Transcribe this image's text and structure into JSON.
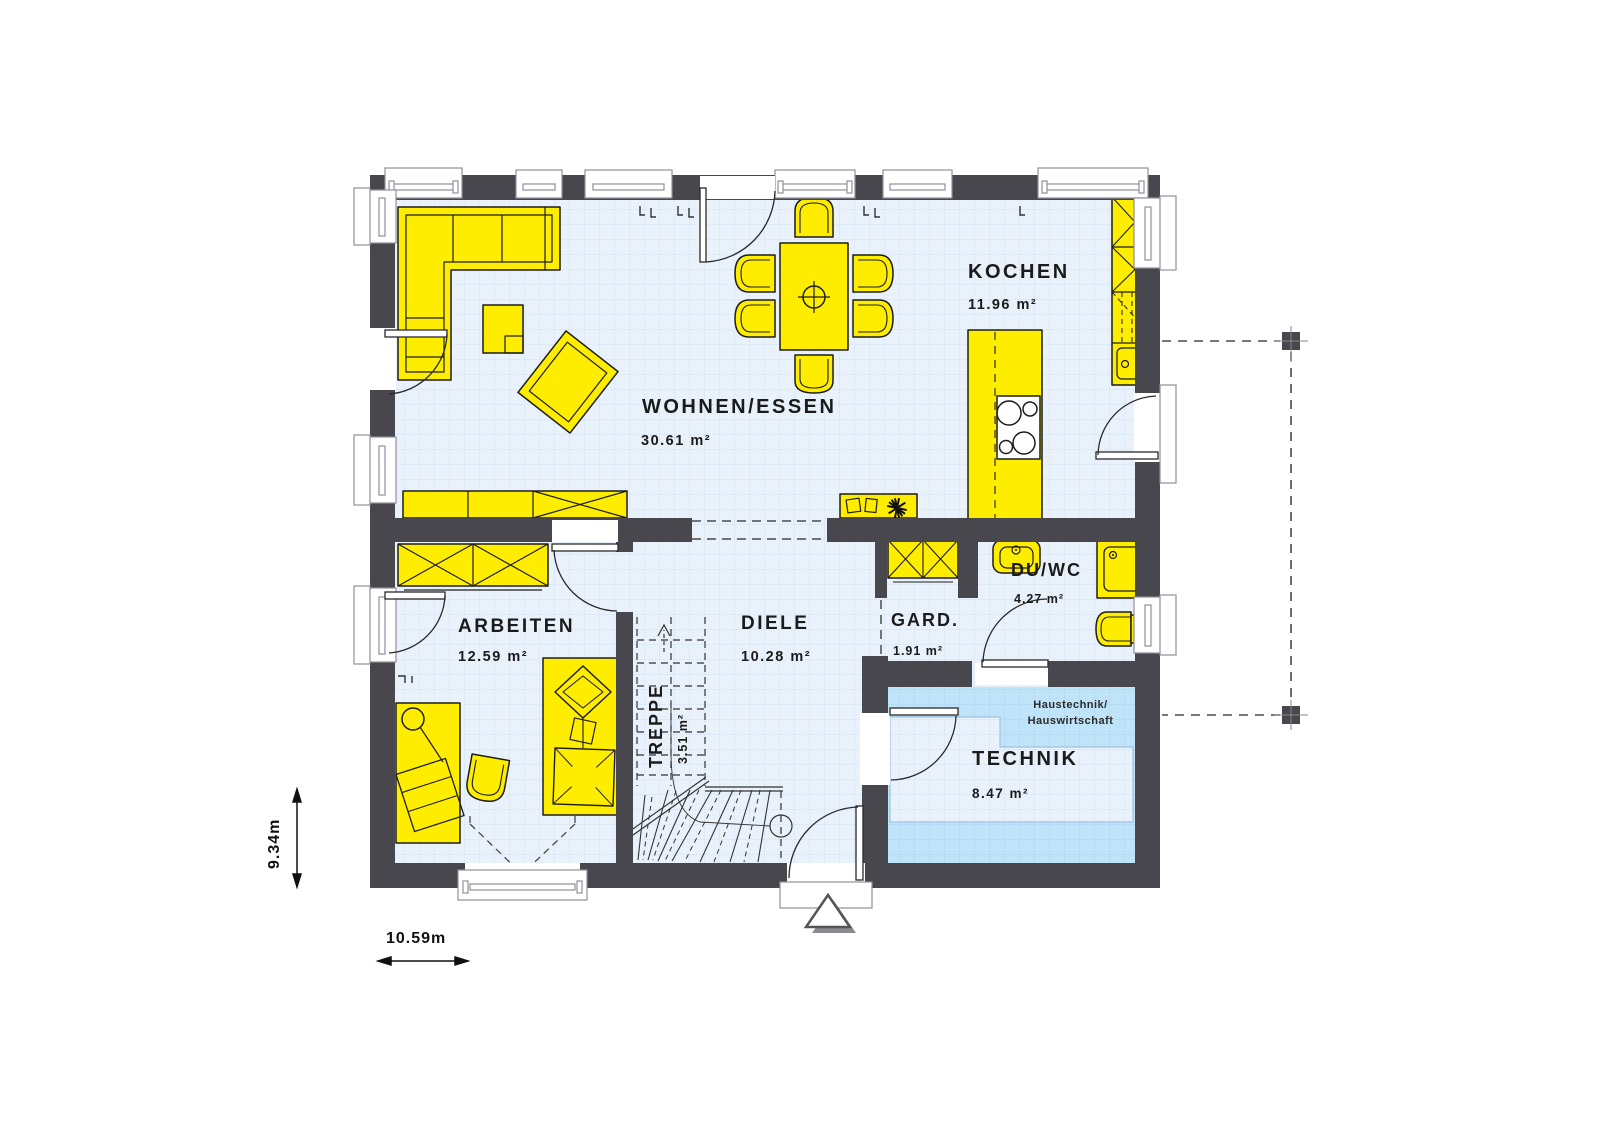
{
  "title": "Erdgeschoss Grundriss",
  "rooms": [
    {
      "id": "wohnen-essen",
      "name": "WOHNEN/ESSEN",
      "area": "30.61 m²"
    },
    {
      "id": "kochen",
      "name": "KOCHEN",
      "area": "11.96 m²"
    },
    {
      "id": "arbeiten",
      "name": "ARBEITEN",
      "area": "12.59 m²"
    },
    {
      "id": "diele",
      "name": "DIELE",
      "area": "10.28 m²"
    },
    {
      "id": "treppe",
      "name": "TREPPE",
      "area": "3.51 m²"
    },
    {
      "id": "garderobe",
      "name": "GARD.",
      "area": "1.91 m²"
    },
    {
      "id": "du-wc",
      "name": "DU/WC",
      "area": "4.27 m²"
    },
    {
      "id": "technik",
      "name": "TECHNIK",
      "area": "8.47 m²"
    }
  ],
  "annotations": {
    "technik_note_line1": "Haustechnik/",
    "technik_note_line2": "Hauswirtschaft"
  },
  "dimensions": {
    "width_label": "10.59m",
    "height_label": "9.34m"
  },
  "colors": {
    "wall": "#47474d",
    "furniture": "#ffed00",
    "outline": "#1d1d1b",
    "floor": "#e9f1fa",
    "floor_grid": "#d2e4f5",
    "technik_fill": "#bfe3f8",
    "window_frame": "#90909a",
    "dashed_line": "#4a4a4a"
  }
}
